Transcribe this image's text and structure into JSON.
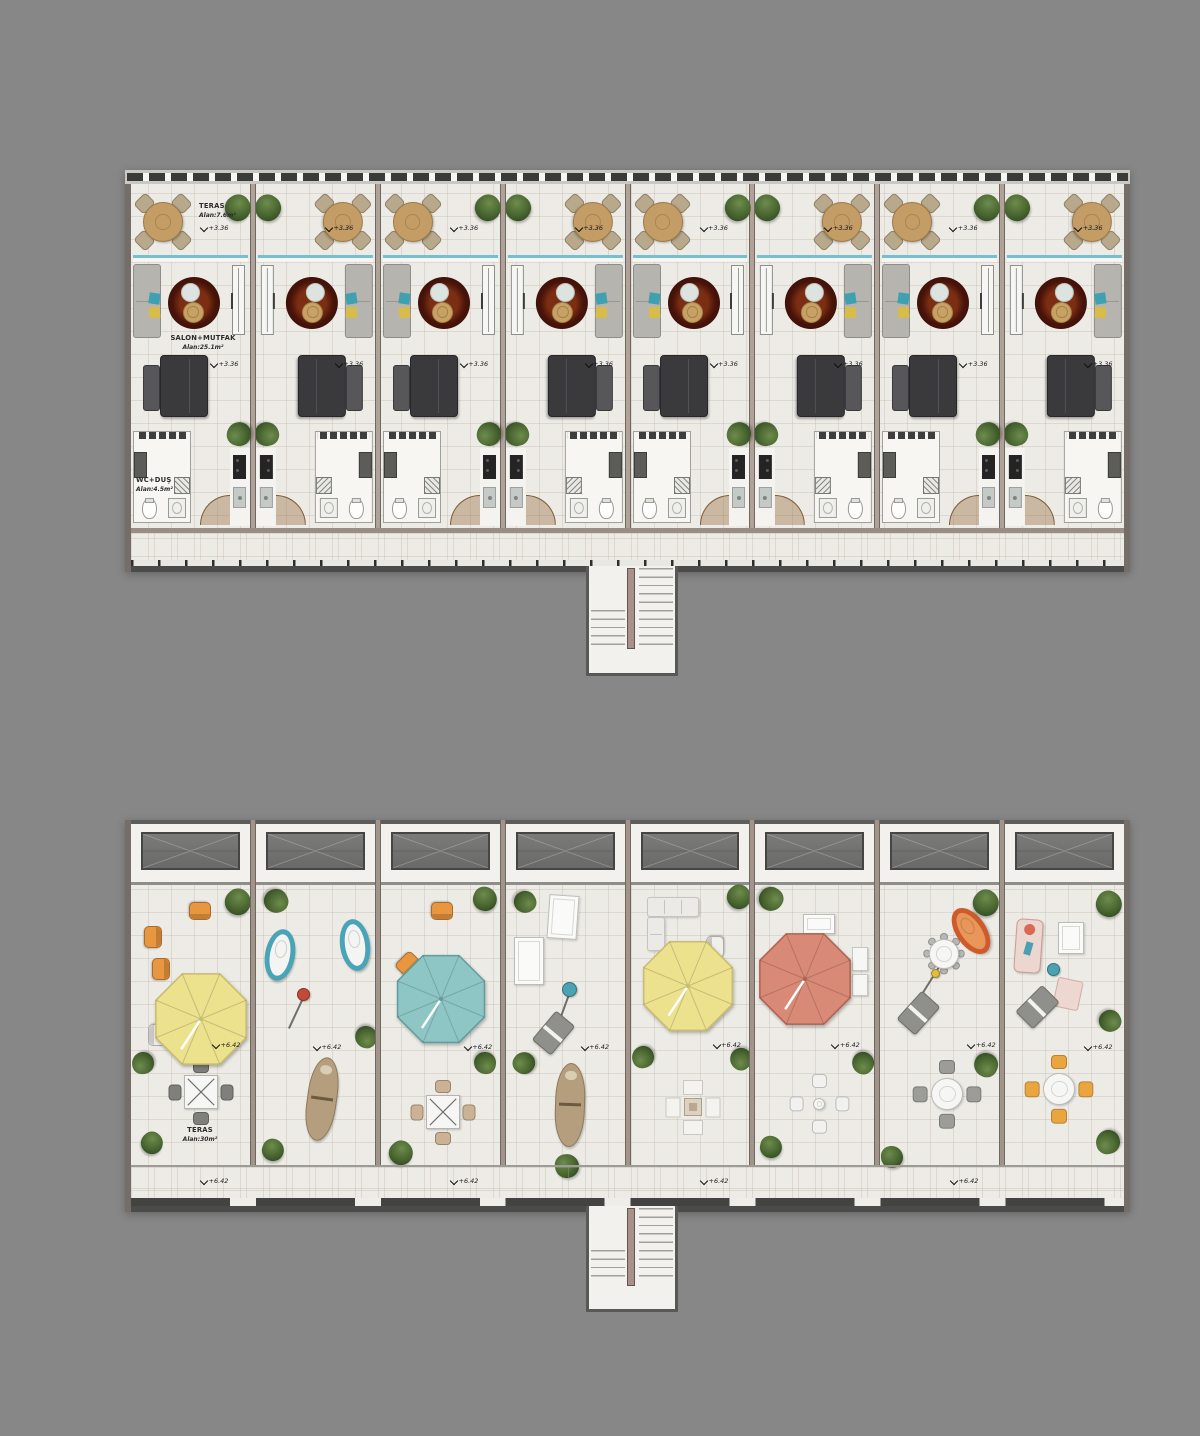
{
  "page": {
    "title": "Apartment floor plan and roof terrace plan",
    "background": "#878787"
  },
  "colors": {
    "background": "#878787",
    "floor": "#edebe6",
    "wall": "#b0a199",
    "roof_wall": "#a2938b",
    "glass_door": "#74bfd0",
    "rug_dark": "#2b0c06",
    "rug_mid": "#7c2e12",
    "umbrella_yellow": "#ece28e",
    "umbrella_teal": "#8ec6c5",
    "umbrella_salmon": "#d88a76",
    "accent_orange": "#e8963f",
    "accent_teal": "#4aa2b2",
    "accent_red": "#c34a38",
    "stair_divider": "#a8918a",
    "railing_dark": "#3a3a38"
  },
  "floor_plan": {
    "name": "upper floor plan",
    "labels": {
      "teras": "TERAS",
      "teras_area": "Alan:7.6m²",
      "salon": "SALON+MUTFAK",
      "salon_area": "Alan:25.1m²",
      "wc": "WC+DUŞ",
      "wc_area": "Alan:4.5m²",
      "level": "+3.36"
    },
    "units": [
      {
        "id": 1,
        "mirrored": false,
        "labeled": true
      },
      {
        "id": 2,
        "mirrored": true,
        "labeled": false
      },
      {
        "id": 3,
        "mirrored": false,
        "labeled": false
      },
      {
        "id": 4,
        "mirrored": true,
        "labeled": false
      },
      {
        "id": 5,
        "mirrored": false,
        "labeled": false
      },
      {
        "id": 6,
        "mirrored": true,
        "labeled": false
      },
      {
        "id": 7,
        "mirrored": false,
        "labeled": false
      },
      {
        "id": 8,
        "mirrored": true,
        "labeled": false
      }
    ]
  },
  "roof_plan": {
    "name": "roof terrace plan",
    "labels": {
      "teras": "TERAS",
      "teras_area": "Alan:30m²",
      "level": "+6.42"
    },
    "corridor_marker_xs": [
      70,
      320,
      570,
      820
    ],
    "units": [
      {
        "id": 1,
        "furniture": [
          {
            "t": "chair",
            "x": 69,
            "y": 26,
            "r": 180,
            "c": "#e8963f"
          },
          {
            "t": "chair",
            "x": 22,
            "y": 52,
            "r": 90,
            "c": "#e8963f"
          },
          {
            "t": "chair",
            "x": 30,
            "y": 84,
            "r": 90,
            "c": "#e8963f"
          },
          {
            "t": "plant",
            "x": 107,
            "y": 17,
            "d": 26
          },
          {
            "t": "parasol",
            "x": 70,
            "y": 134,
            "d": 104,
            "c": "#ece28e",
            "s": "#c9bd6e"
          },
          {
            "t": "chair",
            "x": 26,
            "y": 150,
            "r": -90,
            "c": "#f0efeb"
          },
          {
            "t": "marker",
            "x": 82,
            "y": 156
          },
          {
            "t": "plant",
            "x": 12,
            "y": 178,
            "d": 22
          },
          {
            "t": "tablex",
            "x": 70,
            "y": 207,
            "c": "#7f7f7b"
          },
          {
            "t": "label",
            "x": 69,
            "y": 241
          },
          {
            "t": "plant",
            "x": 21,
            "y": 258,
            "d": 22
          }
        ]
      },
      {
        "id": 2,
        "furniture": [
          {
            "t": "plant",
            "x": 20,
            "y": 16,
            "d": 24
          },
          {
            "t": "egg",
            "x": 24,
            "y": 70,
            "r": 10,
            "c": "#4aa4b8"
          },
          {
            "t": "egg",
            "x": 99,
            "y": 60,
            "r": -8,
            "c": "#4aa4b8"
          },
          {
            "t": "stem",
            "x": 48,
            "y": 109,
            "len": 38,
            "r": 115
          },
          {
            "t": "stool",
            "x": 48,
            "y": 109,
            "d": 13,
            "c": "#c34a38"
          },
          {
            "t": "plant",
            "x": 110,
            "y": 152,
            "d": 22
          },
          {
            "t": "marker",
            "x": 58,
            "y": 158
          },
          {
            "t": "boat",
            "x": 66,
            "y": 214,
            "r": 8
          },
          {
            "t": "plant",
            "x": 17,
            "y": 265,
            "d": 22
          }
        ]
      },
      {
        "id": 3,
        "furniture": [
          {
            "t": "chair",
            "x": 61,
            "y": 26,
            "r": 180,
            "c": "#e8963f"
          },
          {
            "t": "plant",
            "x": 104,
            "y": 14,
            "d": 24
          },
          {
            "t": "chair",
            "x": 27,
            "y": 79,
            "r": 135,
            "c": "#e8963f"
          },
          {
            "t": "parasol",
            "x": 60,
            "y": 114,
            "d": 100,
            "c": "#8ec6c5",
            "s": "#5f9e9e"
          },
          {
            "t": "marker",
            "x": 84,
            "y": 158
          },
          {
            "t": "plant",
            "x": 104,
            "y": 178,
            "d": 22
          },
          {
            "t": "tablex",
            "x": 62,
            "y": 227,
            "c": "#cbb294"
          },
          {
            "t": "plant",
            "x": 20,
            "y": 268,
            "d": 24
          }
        ]
      },
      {
        "id": 4,
        "furniture": [
          {
            "t": "plant",
            "x": 19,
            "y": 17,
            "d": 22
          },
          {
            "t": "mattress",
            "x": 57,
            "y": 32,
            "w": 30,
            "h": 44,
            "r": 4
          },
          {
            "t": "mattress",
            "x": 23,
            "y": 76,
            "w": 30,
            "h": 48,
            "r": 0
          },
          {
            "t": "stem",
            "x": 64,
            "y": 104,
            "len": 46,
            "r": 110
          },
          {
            "t": "stool",
            "x": 64,
            "y": 104,
            "d": 15,
            "c": "#4aa2b2"
          },
          {
            "t": "glounger",
            "x": 48,
            "y": 148,
            "r": 40
          },
          {
            "t": "marker",
            "x": 76,
            "y": 158
          },
          {
            "t": "plant",
            "x": 18,
            "y": 178,
            "d": 22
          },
          {
            "t": "boat",
            "x": 64,
            "y": 220,
            "r": 2
          },
          {
            "t": "plant",
            "x": 61,
            "y": 281,
            "d": 24
          }
        ]
      },
      {
        "id": 5,
        "furniture": [
          {
            "t": "sofaL",
            "x": 16,
            "y": 12
          },
          {
            "t": "plant",
            "x": 108,
            "y": 12,
            "d": 24
          },
          {
            "t": "parasol",
            "x": 57,
            "y": 101,
            "d": 102,
            "c": "#ece28e",
            "s": "#c9bd6e"
          },
          {
            "t": "chair",
            "x": 84,
            "y": 62,
            "r": -90,
            "c": "#f0efeb"
          },
          {
            "t": "chair",
            "x": 88,
            "y": 96,
            "r": -90,
            "c": "#f0efeb"
          },
          {
            "t": "marker",
            "x": 83,
            "y": 156
          },
          {
            "t": "plant",
            "x": 12,
            "y": 172,
            "d": 22
          },
          {
            "t": "cross",
            "x": 62,
            "y": 222
          },
          {
            "t": "plant",
            "x": 110,
            "y": 174,
            "d": 22
          }
        ]
      },
      {
        "id": 6,
        "furniture": [
          {
            "t": "plant",
            "x": 16,
            "y": 14,
            "d": 24
          },
          {
            "t": "mattress",
            "x": 64,
            "y": 39,
            "w": 32,
            "h": 20,
            "r": 0
          },
          {
            "t": "parasol",
            "x": 50,
            "y": 94,
            "d": 104,
            "c": "#d88a76",
            "s": "#b06352"
          },
          {
            "t": "sidetable",
            "x": 105,
            "y": 74,
            "w": 16,
            "h": 24
          },
          {
            "t": "sidetable",
            "x": 105,
            "y": 100,
            "w": 16,
            "h": 22
          },
          {
            "t": "marker",
            "x": 77,
            "y": 156
          },
          {
            "t": "roundset",
            "x": 64,
            "y": 219,
            "td": 12,
            "cd": 15,
            "off": 23,
            "c": "#f1f1ef"
          },
          {
            "t": "plant",
            "x": 108,
            "y": 178,
            "d": 22
          },
          {
            "t": "plant",
            "x": 16,
            "y": 262,
            "d": 22
          }
        ]
      },
      {
        "id": 7,
        "furniture": [
          {
            "t": "plant",
            "x": 106,
            "y": 18,
            "d": 26
          },
          {
            "t": "egg",
            "x": 91,
            "y": 46,
            "r": -35,
            "c": "#cf5a2c",
            "f": "#e8965a"
          },
          {
            "t": "stem",
            "x": 58,
            "y": 82,
            "len": 52,
            "r": 122
          },
          {
            "t": "roundset",
            "x": 64,
            "y": 69,
            "td": 30,
            "cd": 8,
            "off": 17,
            "n": 8,
            "c": "#b8b8b4"
          },
          {
            "t": "stool",
            "x": 55,
            "y": 88,
            "d": 9,
            "c": "#e2bc3e"
          },
          {
            "t": "glounger",
            "x": 38,
            "y": 128,
            "r": 42
          },
          {
            "t": "marker",
            "x": 88,
            "y": 156
          },
          {
            "t": "roundset",
            "x": 67,
            "y": 209,
            "td": 32,
            "cd": 16,
            "off": 27,
            "c": "#9c9c98"
          },
          {
            "t": "plant",
            "x": 106,
            "y": 180,
            "d": 24
          },
          {
            "t": "plant",
            "x": 12,
            "y": 272,
            "d": 22
          }
        ]
      },
      {
        "id": 8,
        "furniture": [
          {
            "t": "plant",
            "x": 104,
            "y": 19,
            "d": 26
          },
          {
            "t": "pinklounger",
            "x": 23,
            "y": 61,
            "r": 4
          },
          {
            "t": "mattress",
            "x": 66,
            "y": 53,
            "w": 26,
            "h": 32,
            "r": 0
          },
          {
            "t": "stool",
            "x": 48,
            "y": 84,
            "d": 13,
            "c": "#49a2b2"
          },
          {
            "t": "glounger",
            "x": 32,
            "y": 122,
            "r": 45
          },
          {
            "t": "mat",
            "x": 63,
            "y": 109,
            "r": 12
          },
          {
            "t": "marker",
            "x": 80,
            "y": 158
          },
          {
            "t": "plant",
            "x": 105,
            "y": 136,
            "d": 22
          },
          {
            "t": "roundset",
            "x": 54,
            "y": 204,
            "td": 32,
            "cd": 16,
            "off": 27,
            "c": "#e9a63e"
          },
          {
            "t": "plant",
            "x": 103,
            "y": 257,
            "d": 24
          }
        ]
      }
    ]
  }
}
